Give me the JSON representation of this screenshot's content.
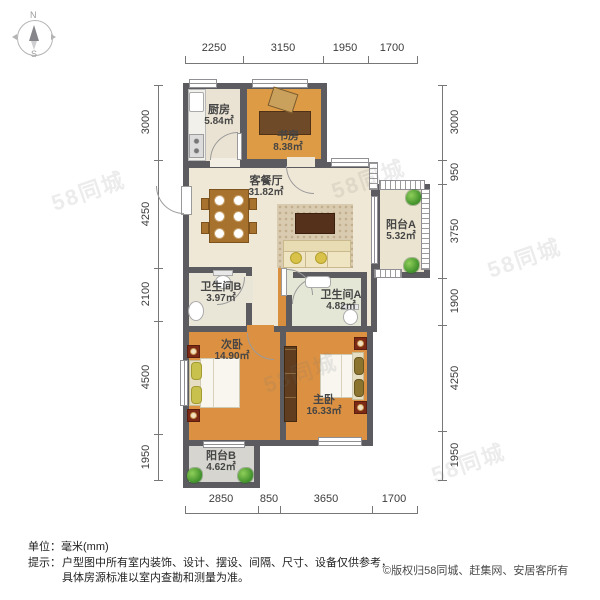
{
  "compass": {
    "north": "N",
    "south": "S"
  },
  "dimensions": {
    "top": [
      "2250",
      "3150",
      "1950",
      "1700"
    ],
    "bottom": [
      "2850",
      "850",
      "3650",
      "1700"
    ],
    "left": [
      "3000",
      "4250",
      "2100",
      "4500",
      "1950"
    ],
    "right": [
      "3000",
      "950",
      "3750",
      "1900",
      "4250",
      "1950"
    ]
  },
  "rooms": {
    "kitchen": {
      "name": "厨房",
      "area": "5.84㎡"
    },
    "study": {
      "name": "书房",
      "area": "8.38㎡"
    },
    "living": {
      "name": "客餐厅",
      "area": "31.82㎡"
    },
    "balcony_a": {
      "name": "阳台A",
      "area": "5.32㎡"
    },
    "bath_b": {
      "name": "卫生间B",
      "area": "3.97㎡"
    },
    "bath_a": {
      "name": "卫生间A",
      "area": "4.82㎡"
    },
    "second_bedroom": {
      "name": "次卧",
      "area": "14.90㎡"
    },
    "master_bedroom": {
      "name": "主卧",
      "area": "16.33㎡"
    },
    "balcony_b": {
      "name": "阳台B",
      "area": "4.62㎡"
    }
  },
  "footer": {
    "unit": "单位：毫米(mm)",
    "tip_label": "提示：",
    "tip_line1": "户型图中所有室内装饰、设计、摆设、间隔、尺寸、设备仅供参考，",
    "tip_line2": "具体房源标准以室内查勘和测量为准。",
    "copyright": "©版权归58同城、赶集网、安居客所有"
  },
  "watermark": {
    "text": "58同城"
  },
  "colors": {
    "wall": "#5b5b60",
    "wood_floor": "#dc9142",
    "cream_floor": "#f0e8d6",
    "kitchen_floor": "#eae3d3",
    "balcony_b_floor": "#d6d5cf"
  }
}
